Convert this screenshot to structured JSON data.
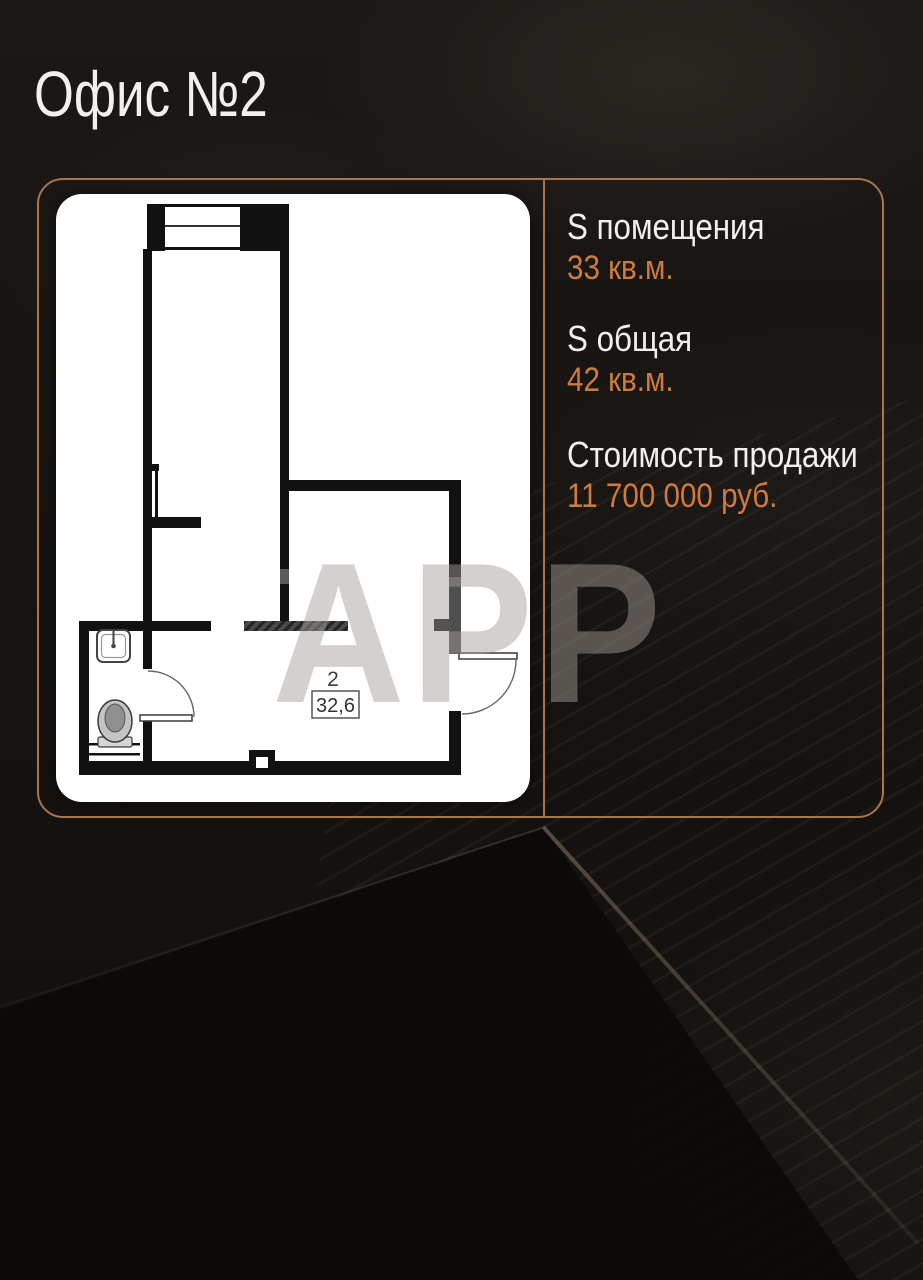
{
  "page": {
    "title": "Офис №2"
  },
  "info_panel": {
    "items": [
      {
        "label": "S помещения",
        "value": "33 кв.м."
      },
      {
        "label": "S общая",
        "value": "42 кв.м."
      },
      {
        "label": "Стоимость продажи",
        "value": "11 700 000 руб."
      }
    ]
  },
  "floor_plan": {
    "room_number": "2",
    "room_area_label": "32,6"
  },
  "watermark": {
    "text": "APP"
  },
  "colors": {
    "accent_orange": "#cf7a3e",
    "panel_border": "#a8764a",
    "background": "#151210",
    "card_background": "#ffffff",
    "plan_walls": "#111111",
    "title_text": "#f2f0ee"
  }
}
